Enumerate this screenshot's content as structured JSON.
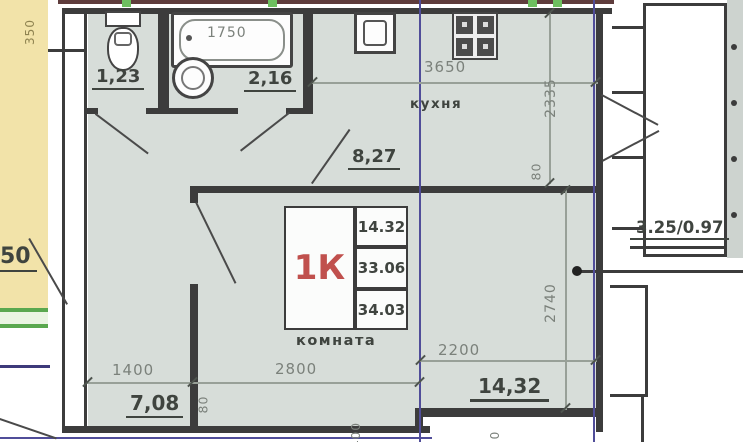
{
  "areas": {
    "toilet": "1,23",
    "bath": "2,16",
    "kitchen": "8,27",
    "hall": "7,08",
    "room": "14,32",
    "balcony": "3.25/0.97",
    "adjacent_partial": "50"
  },
  "room_labels": {
    "kitchen": "кухня",
    "room": "комната"
  },
  "apartment_card": {
    "type": "1К",
    "rows": [
      "14.32",
      "33.06",
      "34.03"
    ]
  },
  "dimensions": {
    "tub_length": "1750",
    "kitchen_width": "3650",
    "kitchen_depth": "2335",
    "kitchen_wall": "80",
    "hall_width": "1400",
    "room_width": "2800",
    "hall_wall": "80",
    "room_width_inner": "2200",
    "room_depth": "2740",
    "left_edge": "350",
    "bottom_a": "400",
    "bottom_b": "0"
  },
  "colors": {
    "floor": "#d7ddd9",
    "adjacent_strip": "#f2e3a9",
    "wall": "#3c3c3c",
    "grid_line": "#504d99",
    "green_mark": "#6dbf5f",
    "type_accent": "#c0504d",
    "dim_text": "#7b817b",
    "area_text": "#3f443f"
  }
}
